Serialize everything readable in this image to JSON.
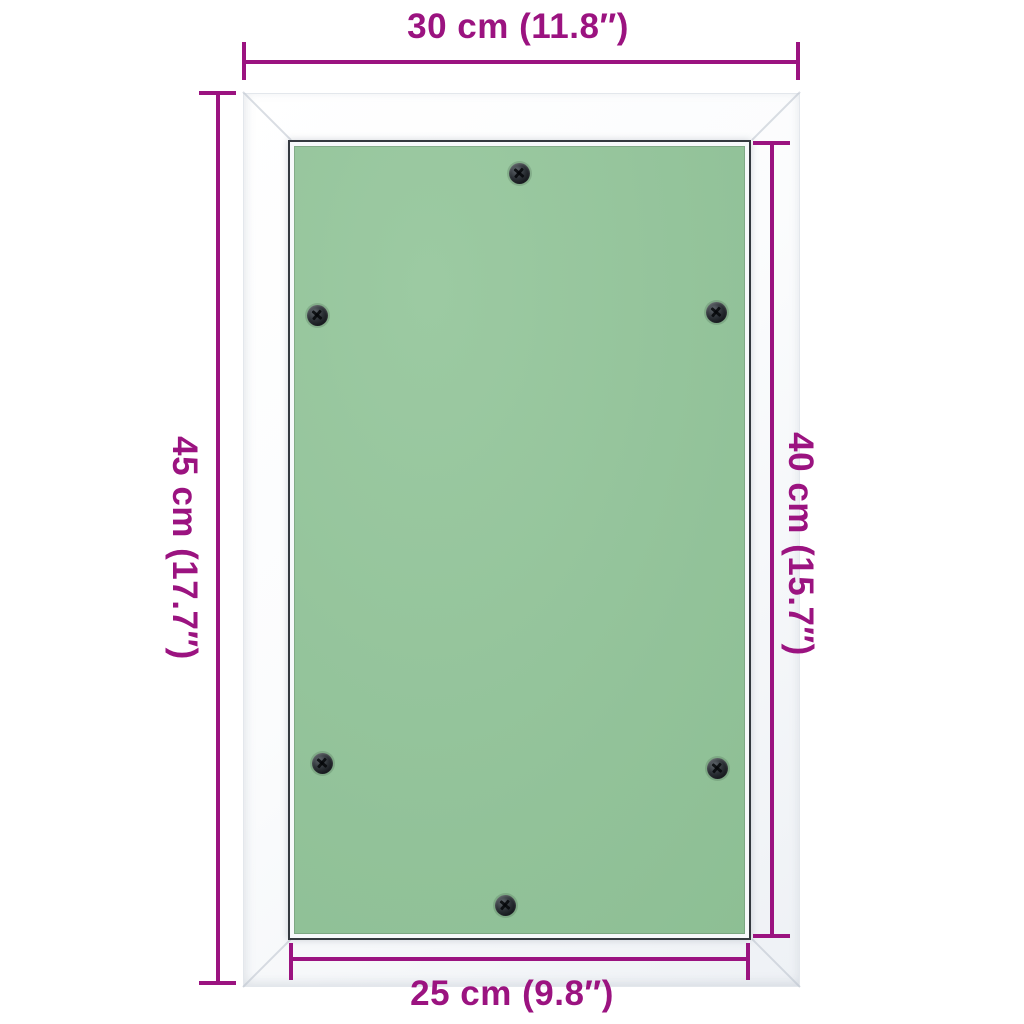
{
  "meta": {
    "description": "Dimension diagram of a wall access panel with white frame, aluminium edge and green gypsum board fixed with six screws"
  },
  "colors": {
    "accent": "#9b1380",
    "background": "#ffffff",
    "frame_white": "#ffffff",
    "panel_green": "#92c299",
    "aluminium_edge": "#34393f",
    "screw_dark": "#15181c"
  },
  "dimensions": {
    "top": {
      "label": "30 cm (11.8″)"
    },
    "left": {
      "label": "45 cm (17.7″)"
    },
    "right": {
      "label": "40 cm (15.7″)"
    },
    "bottom": {
      "label": "25 cm (9.8″)"
    }
  },
  "panel": {
    "screws": [
      {
        "name": "screw-top-center",
        "x": 519,
        "y": 173
      },
      {
        "name": "screw-upper-left",
        "x": 317,
        "y": 315
      },
      {
        "name": "screw-upper-right",
        "x": 716,
        "y": 312
      },
      {
        "name": "screw-lower-left",
        "x": 322,
        "y": 763
      },
      {
        "name": "screw-lower-right",
        "x": 717,
        "y": 768
      },
      {
        "name": "screw-bottom-center",
        "x": 505,
        "y": 905
      }
    ]
  }
}
